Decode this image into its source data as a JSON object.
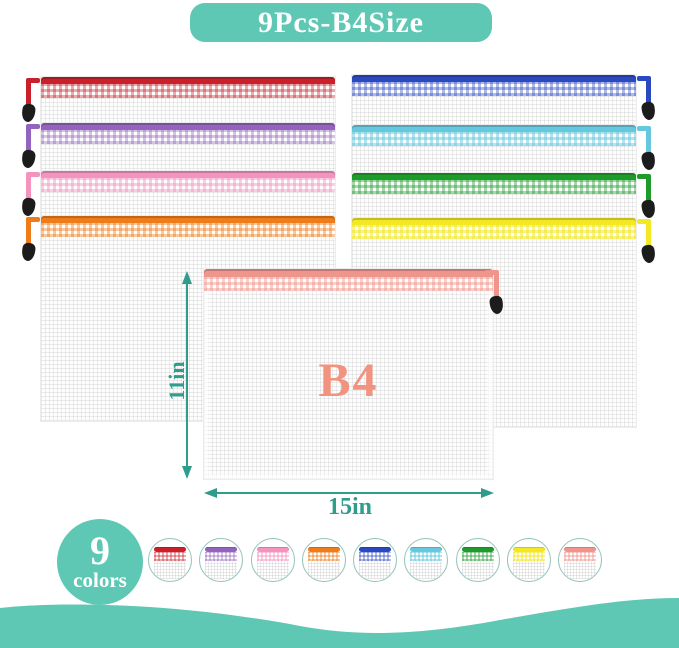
{
  "title_badge": {
    "label": "9Pcs-B4Size",
    "bg": "#5EC8B5"
  },
  "front_pouch": {
    "label": "B4",
    "label_color": "#F2937F",
    "zip": "#F0958B",
    "band": "rgba(240,149,139,0.45)"
  },
  "dimension": {
    "height": "11in",
    "width": "15in",
    "arrow_color": "#2F9C8C"
  },
  "colors_badge": {
    "count": "9",
    "label": "colors"
  },
  "stacks": {
    "left": [
      {
        "name": "red",
        "zip": "#C9202B",
        "band": "rgba(201,32,43,0.38)"
      },
      {
        "name": "purple",
        "zip": "#9463BD",
        "band": "rgba(148,99,189,0.38)"
      },
      {
        "name": "pink",
        "zip": "#F593BE",
        "band": "rgba(245,147,190,0.45)"
      },
      {
        "name": "orange",
        "zip": "#EE7C1B",
        "band": "rgba(238,124,27,0.42)"
      }
    ],
    "right": [
      {
        "name": "blue",
        "zip": "#2A48BF",
        "band": "rgba(42,72,191,0.38)"
      },
      {
        "name": "sky-blue",
        "zip": "#66C8DF",
        "band": "rgba(102,200,223,0.5)"
      },
      {
        "name": "green",
        "zip": "#1F9B2C",
        "band": "rgba(31,155,44,0.4)"
      },
      {
        "name": "yellow",
        "zip": "#F3E824",
        "band": "rgba(243,232,36,0.55)"
      }
    ]
  },
  "swatches": [
    {
      "name": "red",
      "zip": "#C9202B",
      "band": "rgba(201,32,43,0.38)"
    },
    {
      "name": "purple",
      "zip": "#9463BD",
      "band": "rgba(148,99,189,0.38)"
    },
    {
      "name": "pink",
      "zip": "#F593BE",
      "band": "rgba(245,147,190,0.45)"
    },
    {
      "name": "orange",
      "zip": "#EE7C1B",
      "band": "rgba(238,124,27,0.42)"
    },
    {
      "name": "blue",
      "zip": "#2A48BF",
      "band": "rgba(42,72,191,0.38)"
    },
    {
      "name": "sky-blue",
      "zip": "#66C8DF",
      "band": "rgba(102,200,223,0.5)"
    },
    {
      "name": "green",
      "zip": "#1F9B2C",
      "band": "rgba(31,155,44,0.4)"
    },
    {
      "name": "yellow",
      "zip": "#F3E824",
      "band": "rgba(243,232,36,0.55)"
    },
    {
      "name": "coral",
      "zip": "#F0958B",
      "band": "rgba(240,149,139,0.45)"
    }
  ]
}
